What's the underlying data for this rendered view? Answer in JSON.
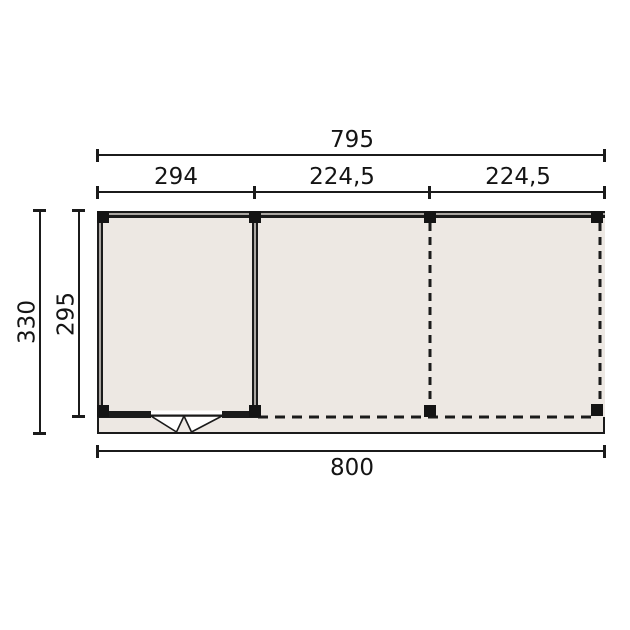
{
  "plan": {
    "type": "floor-plan-top-view",
    "dimensions": {
      "top_total": "795",
      "bay1": "294",
      "bay2": "224,5",
      "bay3": "224,5",
      "left_total": "330",
      "left_inner": "295",
      "bottom_total": "800"
    },
    "features": {
      "bays": 3,
      "posts": 8,
      "door": "double-door-symbol-in-bay-1",
      "open_sides_style": "dashed"
    },
    "colors": {
      "background": "#ffffff",
      "floor_fill": "#EDE8E3",
      "line": "#1b1b1b",
      "wall_core": "#aaa6a2",
      "post": "#141414"
    }
  }
}
